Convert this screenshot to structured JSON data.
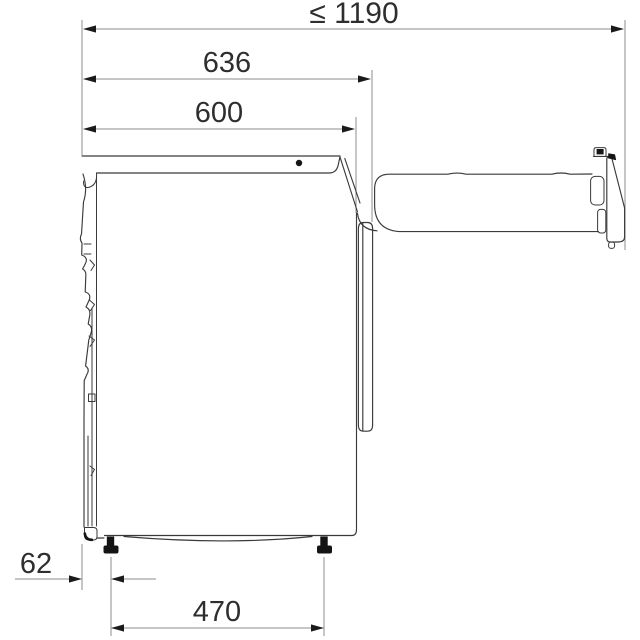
{
  "page": {
    "background": "#ffffff"
  },
  "diagram": {
    "type": "technical-dimension-drawing",
    "subject": "washing-machine-side-view-door-open",
    "unit": "mm",
    "dimensions": {
      "total_depth_door_open": {
        "label": "≤ 1190",
        "value": 1190,
        "qualifier": "max"
      },
      "depth_with_door": {
        "label": "636",
        "value": 636
      },
      "body_depth": {
        "label": "600",
        "value": 600
      },
      "rear_to_foot": {
        "label": "62",
        "value": 62
      },
      "foot_spacing": {
        "label": "470",
        "value": 470
      }
    },
    "colors": {
      "outline": "#3a3a3a",
      "dimension_line": "#8c8c8c",
      "arrow": "#1a1a1a",
      "label_text": "#2e2e2e",
      "fill_solid": "#141414",
      "background": "#ffffff"
    }
  }
}
